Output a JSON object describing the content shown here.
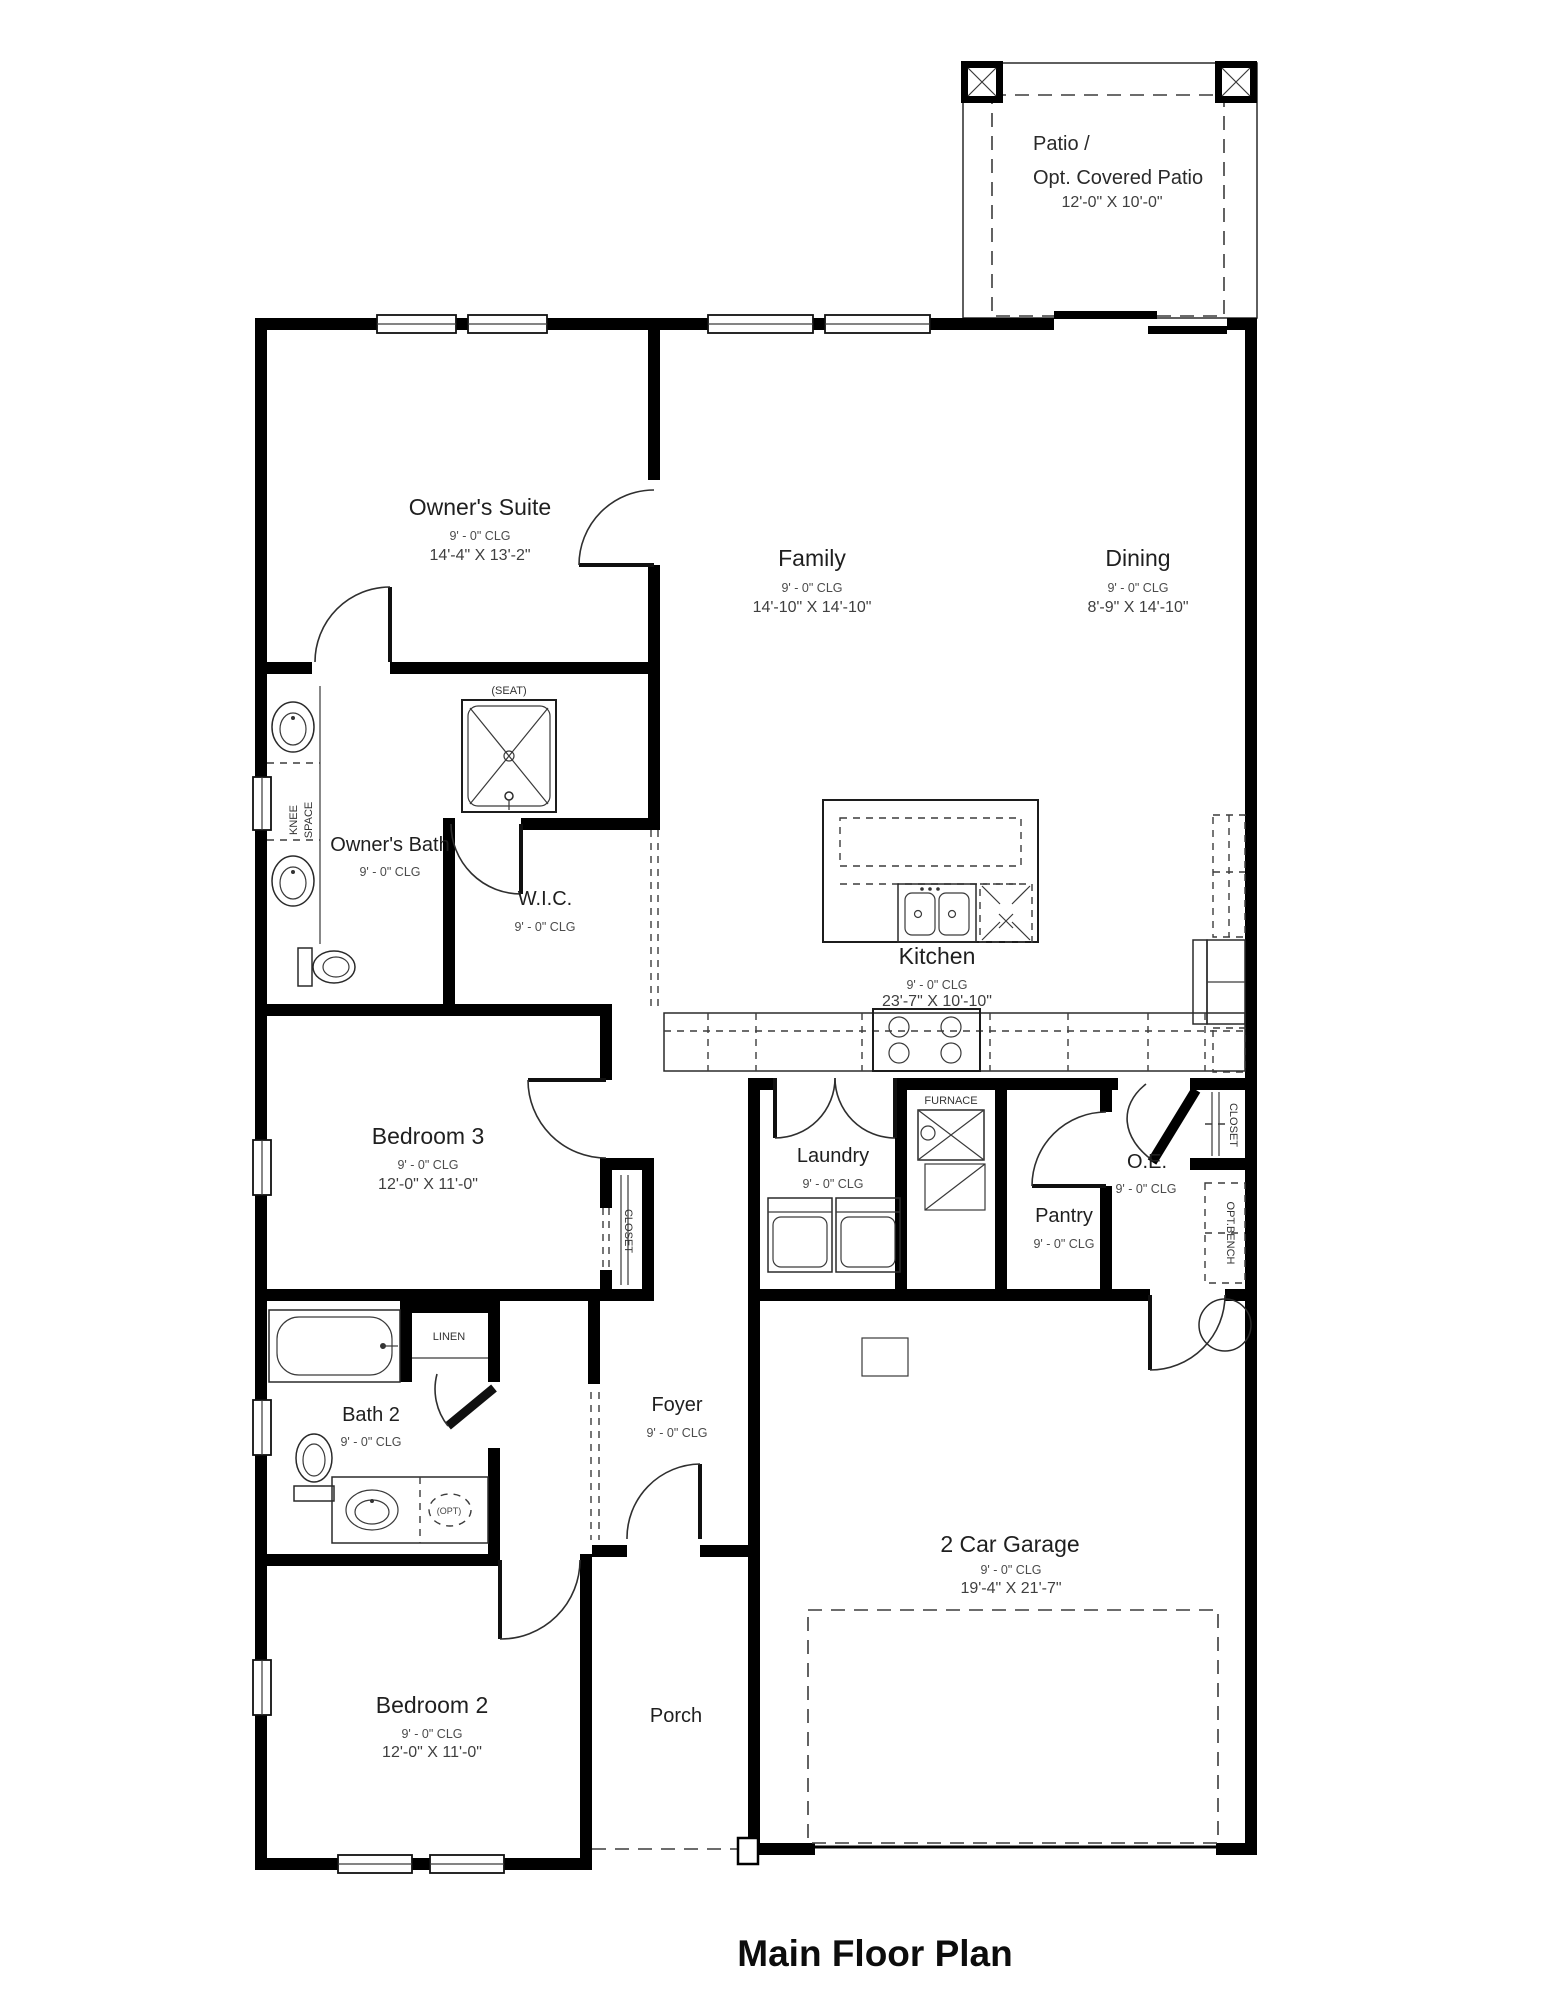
{
  "title": "Main Floor Plan",
  "colors": {
    "wall": "#000000",
    "line": "#2a2a2a",
    "text": "#1f1f1f"
  },
  "rooms": {
    "patio": {
      "name_line1": "Patio /",
      "name_line2": "Opt. Covered Patio",
      "dims": "12'-0\" X 10'-0\""
    },
    "owners_suite": {
      "name": "Owner's Suite",
      "clg": "9' - 0\" CLG",
      "dims": "14'-4\" X 13'-2\""
    },
    "family": {
      "name": "Family",
      "clg": "9' - 0\" CLG",
      "dims": "14'-10\" X 14'-10\""
    },
    "dining": {
      "name": "Dining",
      "clg": "9' - 0\" CLG",
      "dims": "8'-9\" X 14'-10\""
    },
    "owners_bath": {
      "name": "Owner's Bath",
      "clg": "9' - 0\" CLG"
    },
    "wic": {
      "name": "W.I.C.",
      "clg": "9' - 0\" CLG"
    },
    "kitchen": {
      "name": "Kitchen",
      "clg": "9' - 0\" CLG",
      "dims": "23'-7\" X 10'-10\""
    },
    "bedroom3": {
      "name": "Bedroom 3",
      "clg": "9' - 0\" CLG",
      "dims": "12'-0\" X 11'-0\""
    },
    "laundry": {
      "name": "Laundry",
      "clg": "9' - 0\" CLG"
    },
    "pantry": {
      "name": "Pantry",
      "clg": "9' - 0\" CLG"
    },
    "oe": {
      "name": "O.E.",
      "clg": "9' - 0\" CLG"
    },
    "bath2": {
      "name": "Bath 2",
      "clg": "9' - 0\" CLG"
    },
    "foyer": {
      "name": "Foyer",
      "clg": "9' - 0\" CLG"
    },
    "garage": {
      "name": "2 Car Garage",
      "clg": "9' - 0\" CLG",
      "dims": "19'-4\" X 21'-7\""
    },
    "bedroom2": {
      "name": "Bedroom 2",
      "clg": "9' - 0\" CLG",
      "dims": "12'-0\" X 11'-0\""
    },
    "porch": {
      "name": "Porch"
    }
  },
  "small_labels": {
    "seat": "(SEAT)",
    "knee_line1": "KNEE",
    "knee_line2": "SPACE",
    "furnace": "FURNACE",
    "linen": "LINEN",
    "closet_bed3": "CLOSET",
    "closet_oe": "CLOSET",
    "opt_bench": "OPT.BENCH",
    "opt_sink": "(OPT)"
  }
}
